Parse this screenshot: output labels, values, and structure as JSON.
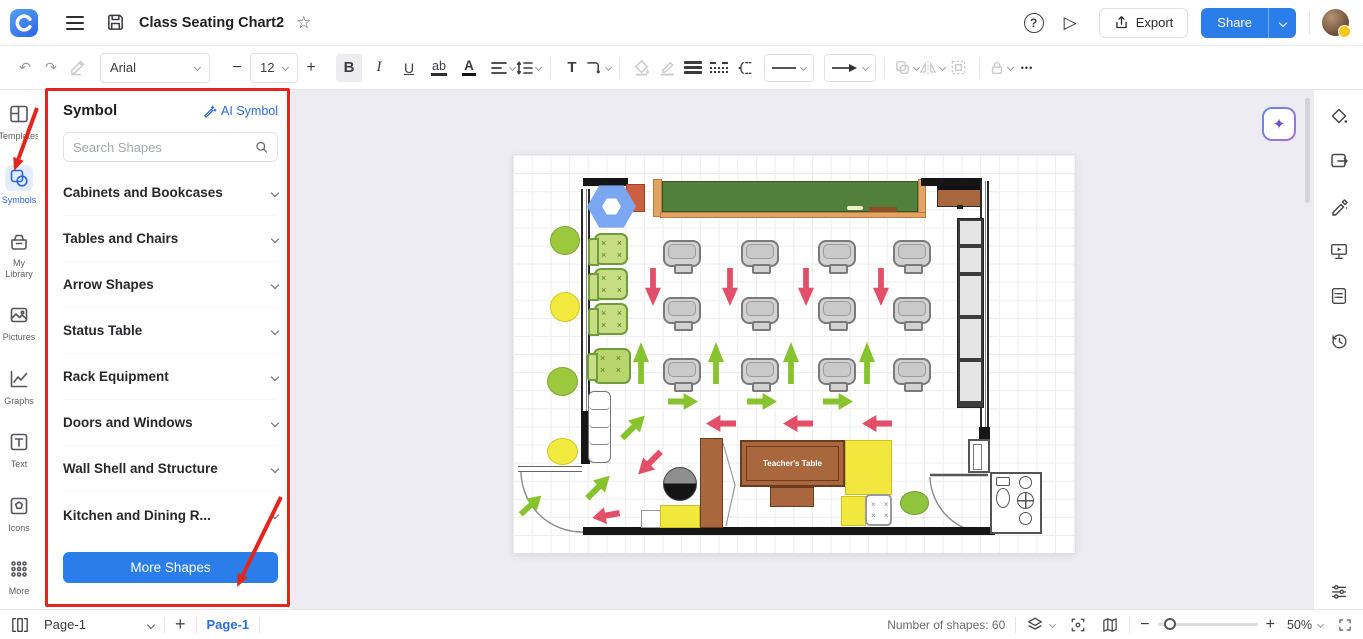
{
  "header": {
    "doc_title": "Class Seating Chart2",
    "export_label": "Export",
    "share_label": "Share"
  },
  "toolbar": {
    "undo": "↶",
    "redo": "↷",
    "font_family": "Arial",
    "font_size": "12",
    "minus": "−",
    "plus": "+",
    "bold": "B",
    "italic": "I",
    "underline": "U",
    "highlight": "ab",
    "font_color": "A",
    "text_tool": "T",
    "more": "•••"
  },
  "left_rail": {
    "items": [
      "Templates",
      "Symbols",
      "My Library",
      "Pictures",
      "Graphs",
      "Text",
      "Icons",
      "More"
    ]
  },
  "symbol_panel": {
    "title": "Symbol",
    "ai_symbol": "AI Symbol",
    "search_placeholder": "Search Shapes",
    "categories": [
      "Cabinets and Bookcases",
      "Tables and Chairs",
      "Arrow Shapes",
      "Status Table",
      "Rack Equipment",
      "Doors and Windows",
      "Wall Shell and Structure",
      "Kitchen and Dining R..."
    ],
    "more_shapes": "More Shapes"
  },
  "canvas": {
    "teacher_table": "Teacher's Table",
    "ai_button_glyph": "✦"
  },
  "status_bar": {
    "page_dropdown": "Page-1",
    "add_page": "+",
    "page_tab": "Page-1",
    "shapes_count": "Number of shapes: 60",
    "zoom_out": "−",
    "zoom_in": "+",
    "zoom_level": "50%"
  },
  "colors": {
    "accent_blue": "#2b7de9",
    "annotation_red": "#e2261c",
    "arrow_green": "#86c32d",
    "arrow_red": "#e34f68",
    "chalkboard_green": "#51803d",
    "wood_brown": "#a9673e"
  }
}
